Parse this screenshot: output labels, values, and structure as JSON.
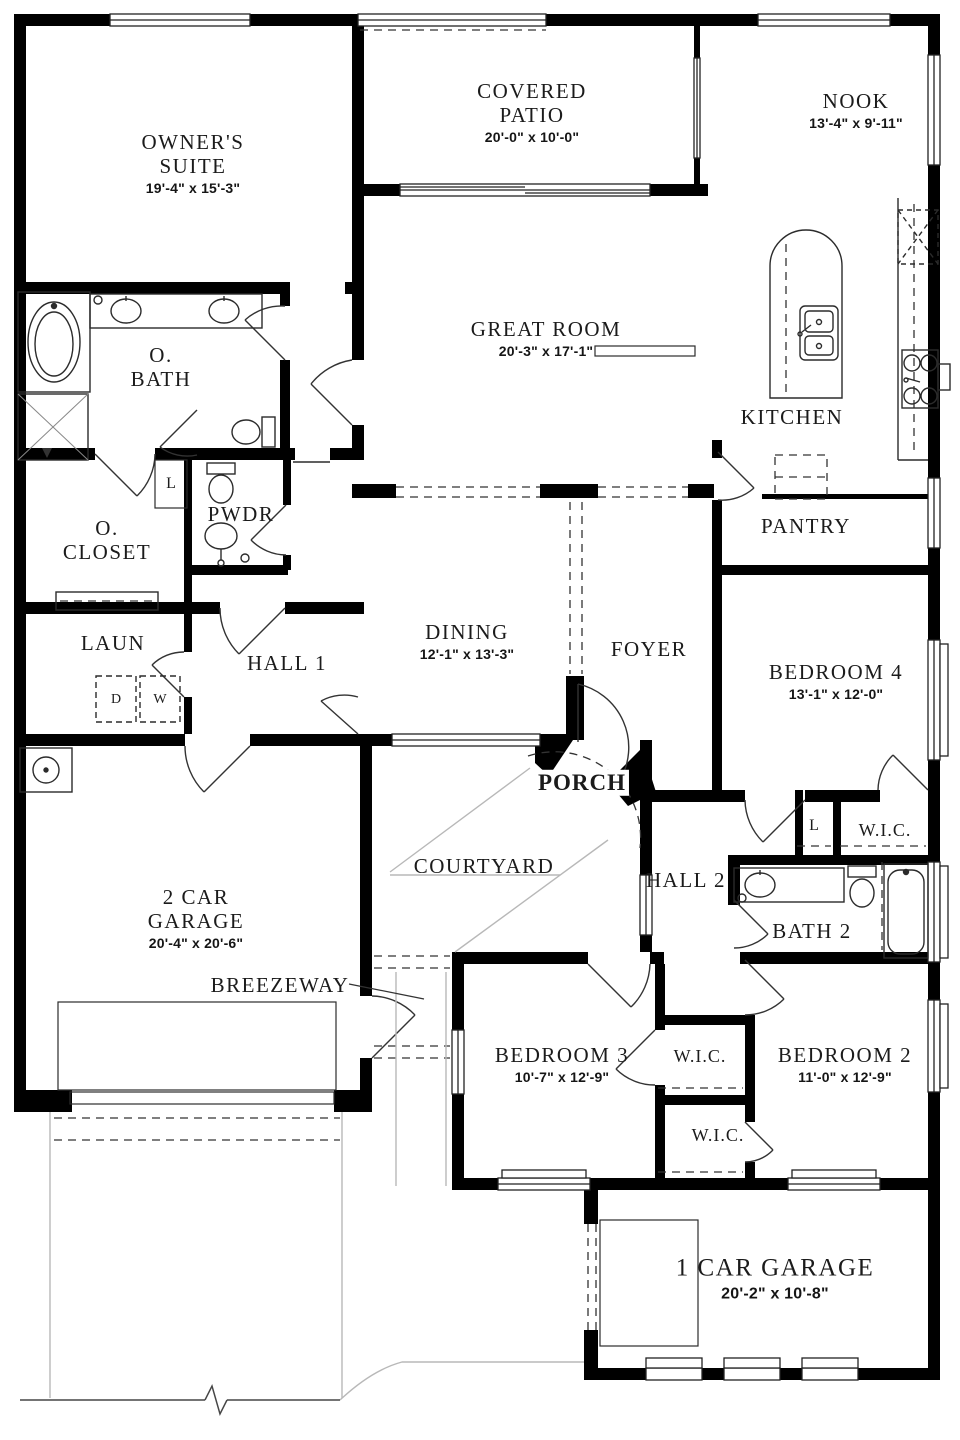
{
  "rooms": {
    "owners_suite": {
      "name": "OWNER'S SUITE",
      "dims": "19'-4\" x 15'-3\""
    },
    "covered_patio": {
      "name": "COVERED PATIO",
      "dims": "20'-0\" x 10'-0\""
    },
    "nook": {
      "name": "NOOK",
      "dims": "13'-4\" x 9'-11\""
    },
    "great_room": {
      "name": "GREAT ROOM",
      "dims": "20'-3\" x 17'-1\""
    },
    "kitchen": {
      "name": "KITCHEN"
    },
    "pantry": {
      "name": "PANTRY"
    },
    "o_bath": {
      "name": "O. BATH"
    },
    "o_closet": {
      "name": "O. CLOSET"
    },
    "pwdr": {
      "name": "PWDR"
    },
    "laun": {
      "name": "LAUN"
    },
    "hall_1": {
      "name": "HALL 1"
    },
    "dining": {
      "name": "DINING",
      "dims": "12'-1\" x 13'-3\""
    },
    "foyer": {
      "name": "FOYER"
    },
    "bedroom_4": {
      "name": "BEDROOM 4",
      "dims": "13'-1\" x 12'-0\""
    },
    "porch": {
      "name": "PORCH"
    },
    "courtyard": {
      "name": "COURTYARD"
    },
    "hall_2": {
      "name": "HALL 2"
    },
    "wic_bed4": {
      "name": "W.I.C."
    },
    "bath_2": {
      "name": "BATH 2"
    },
    "garage_2": {
      "name": "2 CAR GARAGE",
      "dims": "20'-4\" x 20'-6\""
    },
    "breezeway": {
      "name": "BREEZEWAY"
    },
    "bedroom_3": {
      "name": "BEDROOM 3",
      "dims": "10'-7\" x 12'-9\""
    },
    "wic_1": {
      "name": "W.I.C."
    },
    "bedroom_2": {
      "name": "BEDROOM 2",
      "dims": "11'-0\" x 12'-9\""
    },
    "wic_2": {
      "name": "W.I.C."
    },
    "garage_1": {
      "name": "1 CAR GARAGE",
      "dims": "20'-2\" x 10'-8\""
    }
  },
  "closets": {
    "linen_1": "L",
    "linen_2": "L"
  },
  "appliances": {
    "dryer": "D",
    "washer": "W"
  },
  "colors": {
    "wall": "#000000",
    "line": "#2b2b2b",
    "site_line": "#b8b8b8",
    "background": "#ffffff"
  }
}
